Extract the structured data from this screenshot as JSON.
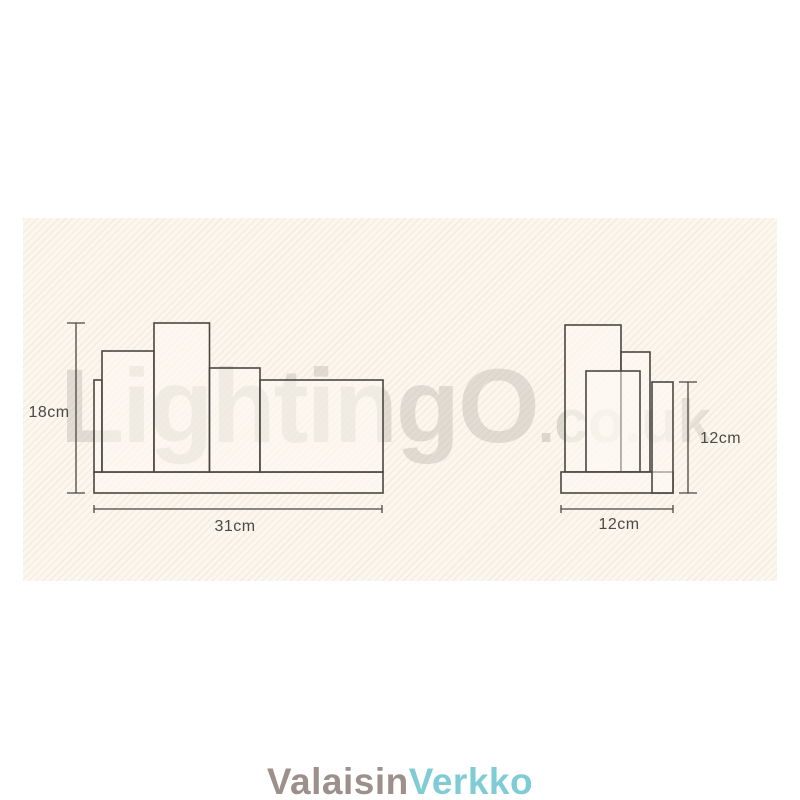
{
  "watermark": {
    "main": "LightingO",
    "co": ".co",
    "uk": ".uk"
  },
  "front_view": {
    "height_label": "18cm",
    "width_label": "31cm"
  },
  "side_view": {
    "height_label": "12cm",
    "width_label": "12cm"
  },
  "brand": {
    "part1": "Valaisin",
    "part2": "Verkko",
    "part1_color": "#9d908a",
    "part2_color": "#80ccd5"
  },
  "colors": {
    "panel_background": "#fbf7ef",
    "panel_texture_line": "#eaddc6",
    "drawing_line": "#4a4741",
    "dimension_text": "#4b4a46",
    "watermark_gray": "#bbb7ac"
  }
}
